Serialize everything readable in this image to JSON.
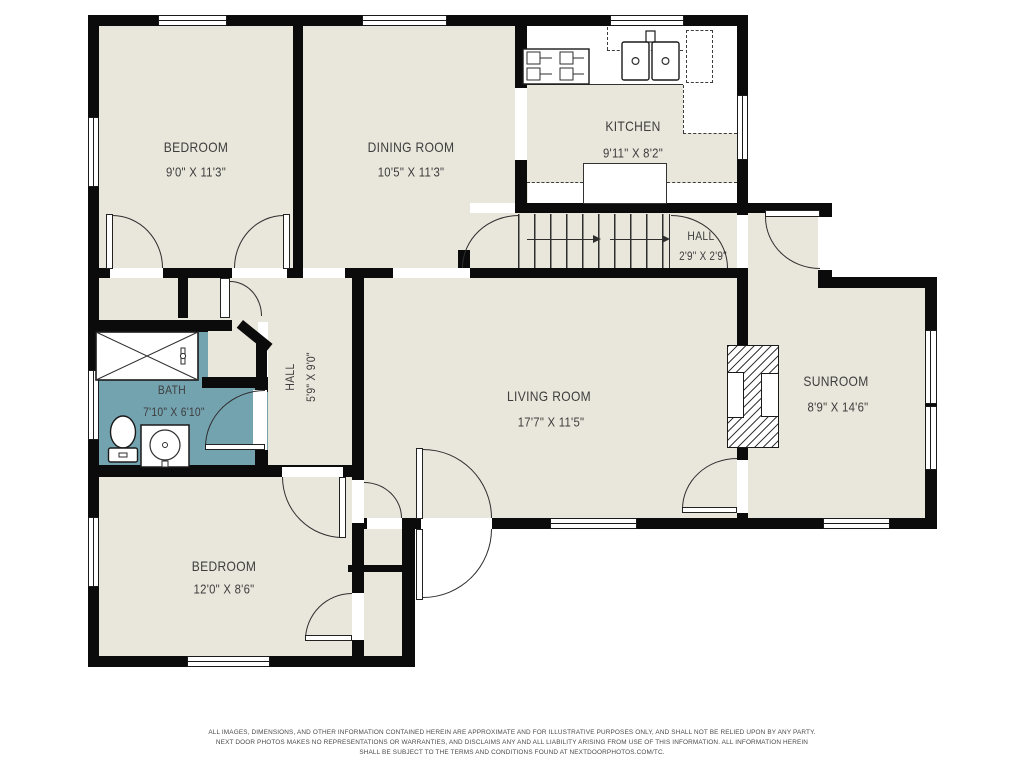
{
  "colors": {
    "wall": "#0b0b0b",
    "floor": "#e9e6db",
    "bath_floor": "#74a3b0",
    "line": "#2e2e2e",
    "label": "#3d3d3d"
  },
  "rooms": [
    {
      "id": "bedroom-1",
      "name": "BEDROOM",
      "dims": "9'0\" X 11'3\""
    },
    {
      "id": "dining-room",
      "name": "DINING ROOM",
      "dims": "10'5\" X 11'3\""
    },
    {
      "id": "kitchen",
      "name": "KITCHEN",
      "dims": "9'11\" X 8'2\""
    },
    {
      "id": "hall-upper",
      "name": "HALL",
      "dims": "2'9\" X 2'9\""
    },
    {
      "id": "living-room",
      "name": "LIVING ROOM",
      "dims": "17'7\" X 11'5\""
    },
    {
      "id": "sunroom",
      "name": "SUNROOM",
      "dims": "8'9\" X 14'6\""
    },
    {
      "id": "bath",
      "name": "BATH",
      "dims": "7'10\" X 6'10\""
    },
    {
      "id": "hall-lower",
      "name": "HALL",
      "dims": "5'9\" X 9'0\""
    },
    {
      "id": "bedroom-2",
      "name": "BEDROOM",
      "dims": "12'0\" X 8'6\""
    }
  ],
  "disclaimer": {
    "line1": "ALL IMAGES, DIMENSIONS, AND OTHER INFORMATION CONTAINED HEREIN ARE APPROXIMATE AND FOR ILLUSTRATIVE PURPOSES ONLY, AND SHALL NOT BE RELIED UPON BY ANY PARTY.",
    "line2": "NEXT DOOR PHOTOS MAKES NO REPRESENTATIONS OR WARRANTIES, AND DISCLAIMS ANY AND ALL LIABILITY ARISING FROM USE OF THIS INFORMATION. ALL INFORMATION HEREIN",
    "line3": "SHALL BE SUBJECT TO THE TERMS AND CONDITIONS FOUND AT NEXTDOORPHOTOS.COM/TC."
  }
}
